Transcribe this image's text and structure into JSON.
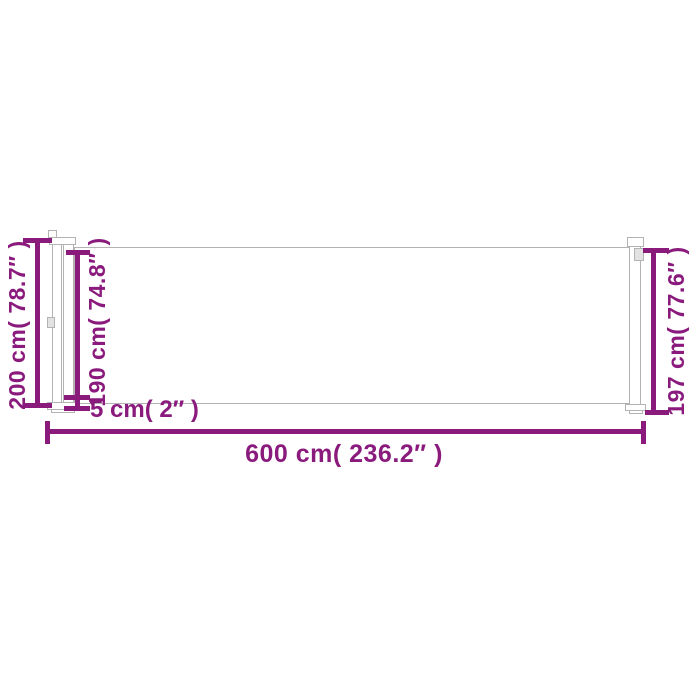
{
  "meta": {
    "description": "Dimension diagram of a retractable side awning / privacy screen with cassette post, fabric panel and pull bar"
  },
  "theme": {
    "accent": "#8a1b7d",
    "outline": "#b3b3b3",
    "background": "#ffffff"
  },
  "labels": {
    "height_total": "200 cm( 78.7″ )",
    "height_fabric": "190 cm( 74.8″ )",
    "gap_bottom": "5 cm( 2″ )",
    "length": "600 cm( 236.2″ )",
    "height_right": "197 cm( 77.6″ )"
  }
}
